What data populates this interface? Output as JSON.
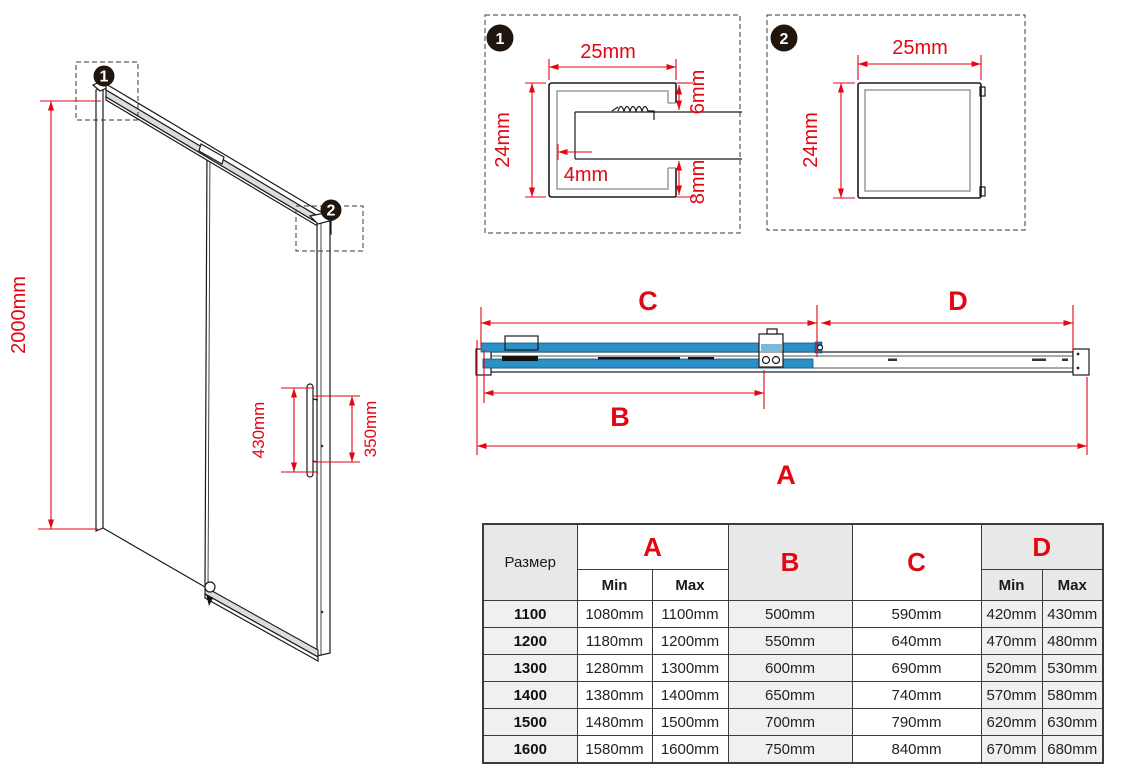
{
  "colors": {
    "dimension_red": "#e30613",
    "glass_blue": "#2b90c8"
  },
  "door_view": {
    "callout_1": "1",
    "callout_2": "2",
    "height": "2000mm",
    "handle_length": "430mm",
    "handle_spacing": "350mm"
  },
  "detail_1": {
    "badge": "1",
    "width": "25mm",
    "height": "24mm",
    "top_inset": "6mm",
    "wall_gap": "4mm",
    "bottom_inset": "8mm"
  },
  "detail_2": {
    "badge": "2",
    "width": "25mm",
    "height": "24mm"
  },
  "section_view": {
    "dim_a": "A",
    "dim_b": "B",
    "dim_c": "C",
    "dim_d": "D"
  },
  "table": {
    "size_header": "Размер",
    "columns": {
      "a": "A",
      "b": "B",
      "c": "C",
      "d": "D"
    },
    "min_label": "Min",
    "max_label": "Max",
    "rows": [
      {
        "size": "1100",
        "a_min": "1080mm",
        "a_max": "1100mm",
        "b": "500mm",
        "c": "590mm",
        "d_min": "420mm",
        "d_max": "430mm"
      },
      {
        "size": "1200",
        "a_min": "1180mm",
        "a_max": "1200mm",
        "b": "550mm",
        "c": "640mm",
        "d_min": "470mm",
        "d_max": "480mm"
      },
      {
        "size": "1300",
        "a_min": "1280mm",
        "a_max": "1300mm",
        "b": "600mm",
        "c": "690mm",
        "d_min": "520mm",
        "d_max": "530mm"
      },
      {
        "size": "1400",
        "a_min": "1380mm",
        "a_max": "1400mm",
        "b": "650mm",
        "c": "740mm",
        "d_min": "570mm",
        "d_max": "580mm"
      },
      {
        "size": "1500",
        "a_min": "1480mm",
        "a_max": "1500mm",
        "b": "700mm",
        "c": "790mm",
        "d_min": "620mm",
        "d_max": "630mm"
      },
      {
        "size": "1600",
        "a_min": "1580mm",
        "a_max": "1600mm",
        "b": "750mm",
        "c": "840mm",
        "d_min": "670mm",
        "d_max": "680mm"
      }
    ]
  }
}
